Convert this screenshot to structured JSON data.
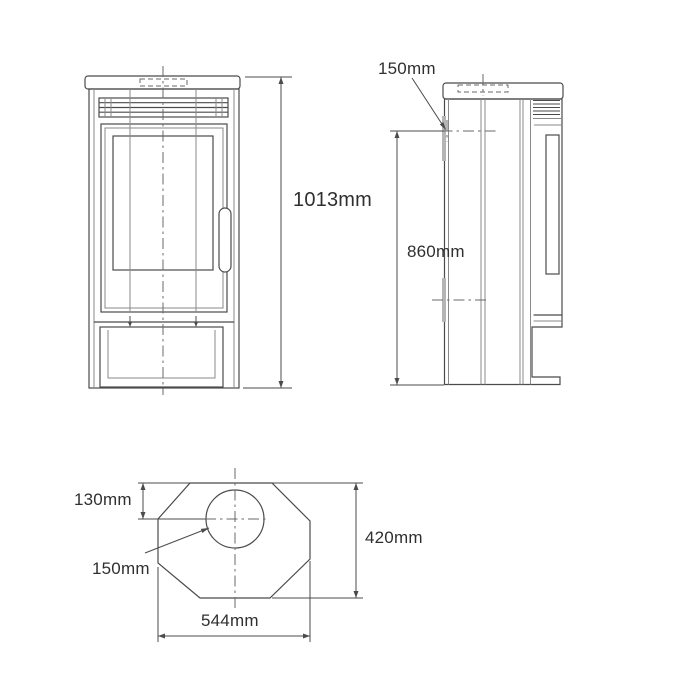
{
  "drawing": {
    "colors": {
      "background": "#ffffff",
      "line": "#4b4b4b",
      "text": "#2f2f2f"
    },
    "front_view": {
      "overall_height_label": "1013mm"
    },
    "side_view": {
      "flue_outlet_label": "150mm",
      "flue_centre_height_label": "860mm"
    },
    "plan_view": {
      "flue_setback_label": "130mm",
      "flue_diameter_label": "150mm",
      "depth_label": "420mm",
      "width_label": "544mm"
    }
  }
}
